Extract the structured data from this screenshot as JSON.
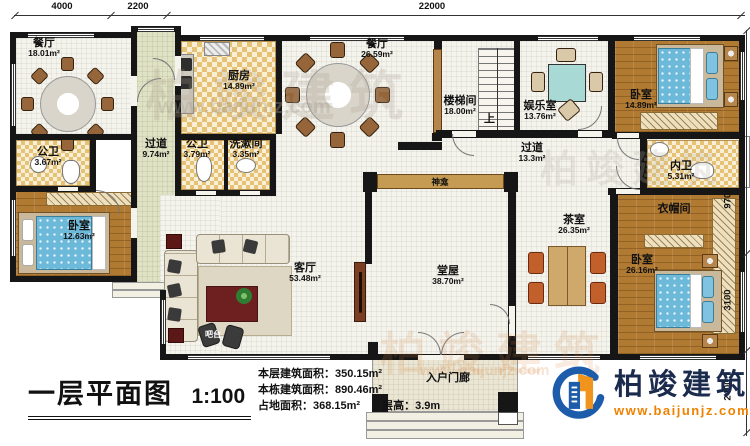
{
  "dims": {
    "top": [
      "4000",
      "2200",
      "22000"
    ],
    "right": [
      "9700",
      "3100",
      "2400"
    ]
  },
  "rooms": [
    {
      "name": "餐厅",
      "area": "18.01m²"
    },
    {
      "name": "公卫",
      "area": "3.67m²"
    },
    {
      "name": "卧室",
      "area": "12.63m²"
    },
    {
      "name": "过道",
      "area": "9.74m²"
    },
    {
      "name": "厨房",
      "area": "14.89m²"
    },
    {
      "name": "公卫",
      "area": "3.79m²"
    },
    {
      "name": "洗漱间",
      "area": "3.35m²"
    },
    {
      "name": "餐厅",
      "area": "26.59m²"
    },
    {
      "name": "楼梯间",
      "area": "18.00m²"
    },
    {
      "name": "娱乐室",
      "area": "13.76m²"
    },
    {
      "name": "卧室",
      "area": "14.89m²"
    },
    {
      "name": "内卫",
      "area": "5.31m²"
    },
    {
      "name": "过道",
      "area": "13.3m²"
    },
    {
      "name": "茶室",
      "area": "26.35m²"
    },
    {
      "name": "衣帽间"
    },
    {
      "name": "卧室",
      "area": "26.16m²"
    },
    {
      "name": "客厅",
      "area": "53.48m²"
    },
    {
      "name": "堂屋",
      "area": "38.70m²"
    },
    {
      "name": "入户门廊"
    }
  ],
  "labels": {
    "shrine": "神龛",
    "up": "上",
    "bar": "吧台"
  },
  "footer": {
    "title": "一层平面图",
    "scale": "1:100",
    "stats": [
      {
        "label": "本层建筑面积：",
        "value": "350.15m²"
      },
      {
        "label": "本栋建筑面积：",
        "value": "890.46m²"
      },
      {
        "label": "占地面积：",
        "value": "368.15m²"
      },
      {
        "label": "层高：",
        "value": "3.9m"
      }
    ]
  },
  "logo": {
    "company": "柏竣建筑",
    "website": "www.baijunjz.com"
  },
  "watermark": {
    "brand": "柏竣建筑",
    "site": "www.baijunjz.com"
  },
  "colors": {
    "wall": "#161616",
    "wood_floor": "#b07a33",
    "corridor_floor": "#dfe2c3",
    "tile": "#e6c277",
    "bed": "#6cb9da",
    "shrine_shelf": "#c59a52",
    "logo_blue": "#1d5cab",
    "logo_orange": "#ef8200"
  }
}
